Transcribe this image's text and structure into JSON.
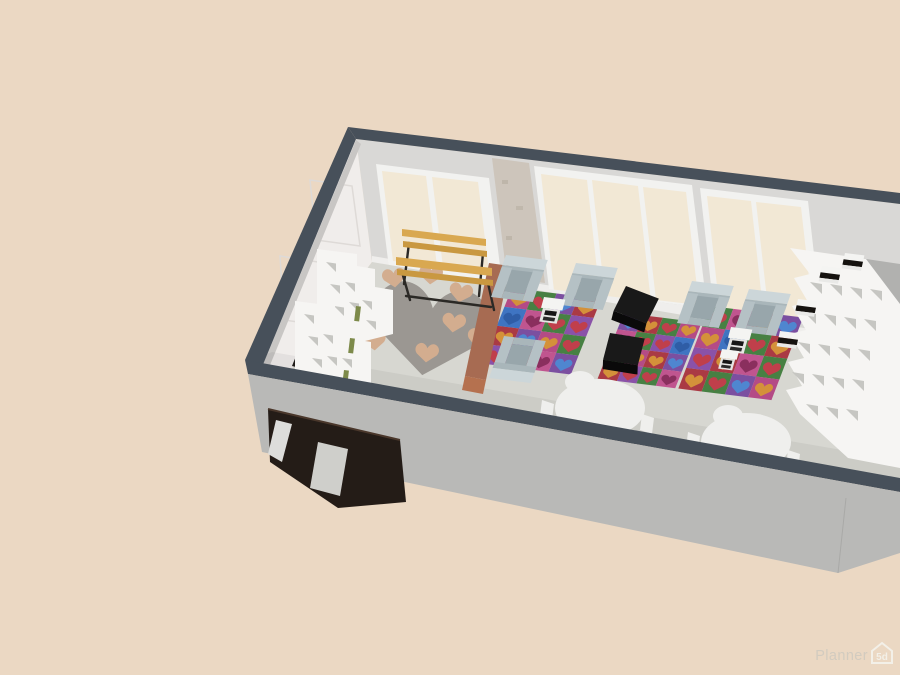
{
  "watermark": {
    "brand": "Planner",
    "badge": "5d"
  },
  "colors": {
    "background": "#ebd8c3",
    "wall_top": "#47505a",
    "wall_exterior": "#b9b9b7",
    "wall_back": "#d9d8d6",
    "wall_left": "#f0edeb",
    "wall_right": "#b1b1af",
    "wall_shadow": "#c8c6c4",
    "floor": "#d7d7d1",
    "baseboard": "#efeeec",
    "window_frame": "#f2f2f0",
    "window_glass": "#f2e8d5",
    "pillar": "#cdc5bb",
    "shelf_white": "#f6f5f3",
    "cubby": "#c6c6c2",
    "bench_wood": "#d9a850",
    "bench_edge": "#c99840",
    "bench_leg": "#2b2926",
    "divider": "#a76b52",
    "divider_cap": "#b5714f",
    "heart_rug": "#9b9792",
    "pillow": "#d3ad8f",
    "chair_body": "#b5c1c5",
    "chair_light": "#ccd6d9",
    "chair_mid": "#a9b6ba",
    "chair_seat": "#98a6ab",
    "ottoman": "#191919",
    "ottoman_dark": "#0a0a0a",
    "table_white": "#f4f4f2",
    "table_side": "#e6e6e4",
    "table_item": "#161616",
    "round_table": "#efefed",
    "door": "#241c17",
    "door_glass": "#dddddb",
    "door_glass2": "#cfcfcb",
    "doorway_shadow": "#1f1b18",
    "book_green": "#7d8a4a",
    "box_black": "#15120f",
    "watermark_text": "#d2cbbf",
    "watermark_badge": "#f3f0e8",
    "rug_palette": [
      "#b44b86",
      "#478043",
      "#7b4fa0",
      "#aa3a44",
      "#3f74c2",
      "#c0558f",
      "#8a52a8"
    ],
    "rug_heart_palette": [
      "#d4913a",
      "#c03f4b",
      "#4f86d0",
      "#2f5da6",
      "#8a2f5e"
    ]
  },
  "rugs": [
    {
      "cells": [
        "#b44b86",
        "#478043",
        "#7b4fa0",
        "#aa3a44",
        "#3f74c2",
        "#c0558f",
        "#478043",
        "#8a52a8",
        "#aa3a44",
        "#7b4fa0",
        "#b44b86",
        "#478043",
        "#8a52a8",
        "#aa3a44",
        "#c0558f",
        "#7b4fa0"
      ],
      "hearts": [
        "#d4913a",
        "#c03f4b",
        "#4f86d0",
        "#d4913a",
        "#2f5da6",
        "#8a2f5e",
        "#c03f4b",
        "#c03f4b",
        "#d4913a",
        "#4f86d0",
        "#d4913a",
        "#c03f4b",
        "#c03f4b",
        "#d4913a",
        "#8a2f5e",
        "#4f86d0"
      ]
    },
    {
      "cells": [
        "#7b4fa0",
        "#aa3a44",
        "#478043",
        "#b44b86",
        "#c0558f",
        "#478043",
        "#8a52a8",
        "#3f74c2",
        "#478043",
        "#b44b86",
        "#aa3a44",
        "#7b4fa0",
        "#aa3a44",
        "#8a52a8",
        "#478043",
        "#c0558f"
      ],
      "hearts": [
        "#4f86d0",
        "#d4913a",
        "#c03f4b",
        "#d4913a",
        "#8a2f5e",
        "#c03f4b",
        "#c03f4b",
        "#2f5da6",
        "#c03f4b",
        "#d4913a",
        "#d4913a",
        "#4f86d0",
        "#d4913a",
        "#c03f4b",
        "#c03f4b",
        "#8a2f5e"
      ]
    },
    {
      "cells": [
        "#478043",
        "#c0558f",
        "#aa3a44",
        "#7b4fa0",
        "#b44b86",
        "#3f74c2",
        "#478043",
        "#aa3a44",
        "#8a52a8",
        "#aa3a44",
        "#c0558f",
        "#478043",
        "#aa3a44",
        "#478043",
        "#7b4fa0",
        "#b44b86"
      ],
      "hearts": [
        "#c03f4b",
        "#8a2f5e",
        "#d4913a",
        "#4f86d0",
        "#d4913a",
        "#2f5da6",
        "#c03f4b",
        "#d4913a",
        "#c03f4b",
        "#d4913a",
        "#8a2f5e",
        "#c03f4b",
        "#d4913a",
        "#c03f4b",
        "#4f86d0",
        "#d4913a"
      ]
    }
  ]
}
